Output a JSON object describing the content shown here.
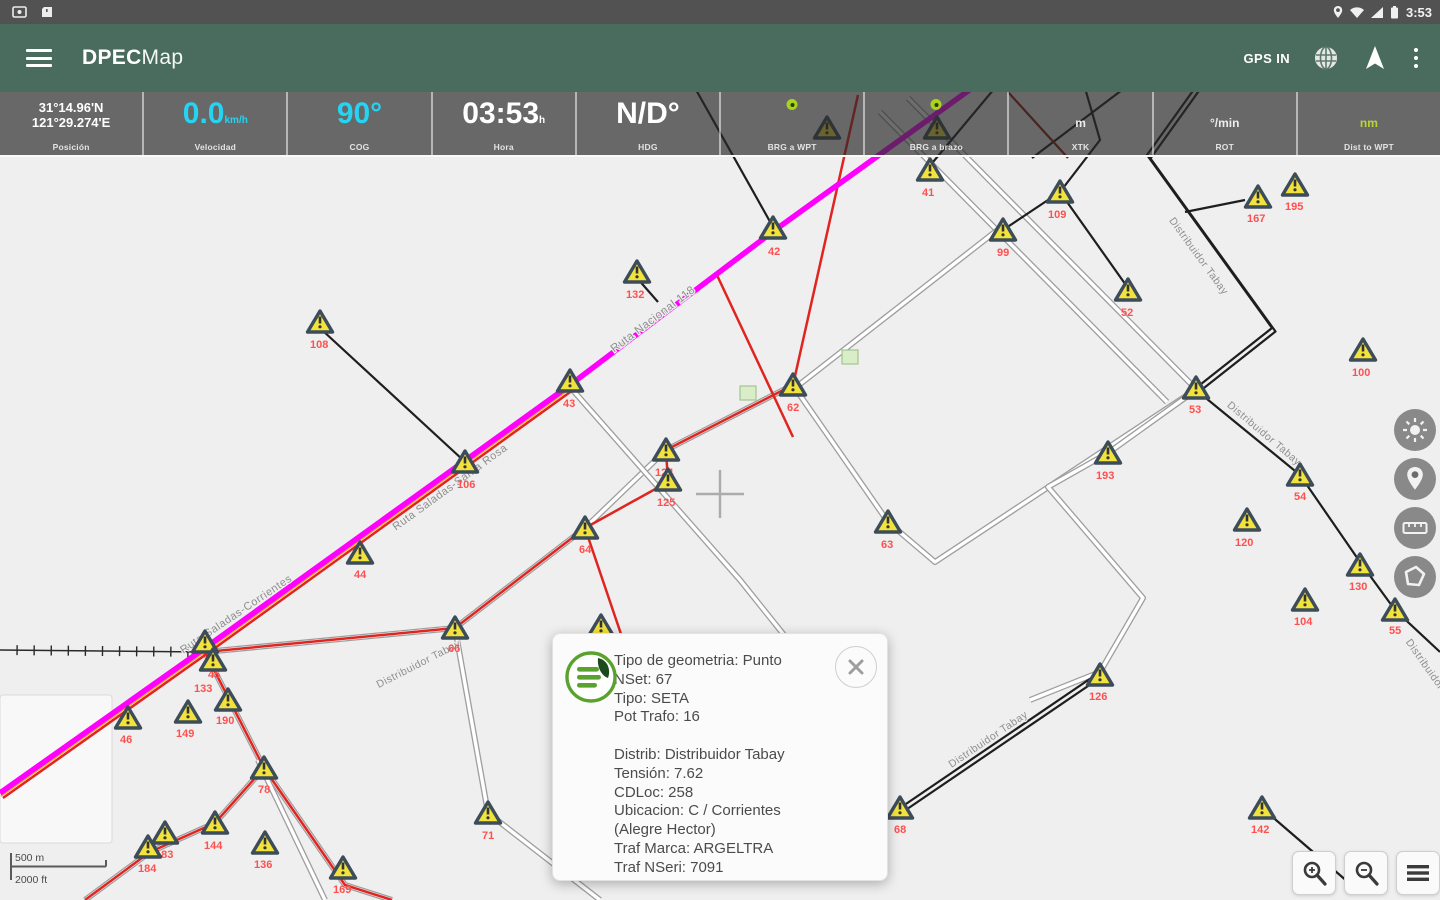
{
  "status_bar": {
    "time": "3:53"
  },
  "app_bar": {
    "title_bold": "DPEC",
    "title_light": "Map",
    "gps_status": "GPS IN"
  },
  "data_bar": {
    "cells": [
      {
        "label": "Posición",
        "style": "coords",
        "value_lines": [
          "31°14.96'N",
          "121°29.274'E"
        ]
      },
      {
        "label": "Velocidad",
        "style": "big-cyan",
        "value": "0.0",
        "unit": "km/h"
      },
      {
        "label": "COG",
        "style": "big-cyan",
        "value": "90°"
      },
      {
        "label": "Hora",
        "style": "big-white",
        "value": "03:53",
        "unit": "h"
      },
      {
        "label": "HDG",
        "style": "big-white",
        "value": "N/D°"
      },
      {
        "label": "BRG a WPT",
        "style": "dot"
      },
      {
        "label": "BRG a brazo",
        "style": "dot"
      },
      {
        "label": "XTK",
        "style": "unit",
        "value": "m"
      },
      {
        "label": "ROT",
        "style": "unit",
        "value": "°/min"
      },
      {
        "label": "Dist to WPT",
        "style": "unit-green",
        "value": "nm"
      }
    ]
  },
  "popup": {
    "lines": [
      "Tipo de geometria: Punto",
      "NSet: 67",
      "Tipo: SETA",
      "Pot Trafo: 16",
      "",
      "Distrib: Distribuidor Tabay",
      "Tensión: 7.62",
      "CDLoc: 258",
      "Ubicacion: C / Corrientes",
      "(Alegre Hector)",
      "Traf Marca: ARGELTRA",
      "Traf NSeri: 7091"
    ]
  },
  "scale_bar": {
    "metric": "500 m",
    "imperial": "2000 ft"
  },
  "map": {
    "colors": {
      "bg": "#EFEFEF",
      "magenta": "#FF00FF",
      "red": "#E02520",
      "darkred": "#8F1A12",
      "orange": "#FFA520",
      "black": "#1E1E1E",
      "road_casing": "#9E9E9E",
      "road_fill": "#FFFFFF",
      "marker_fill": "#F2E23C",
      "marker_stroke": "#3D4C59",
      "label_red": "#FF5050",
      "road_label": "#8E8E8E",
      "building_fill": "#D9EDC8",
      "building_stroke": "#A3C58F",
      "crosshair": "#ABABAB"
    },
    "white_blocks": [
      {
        "x": 0,
        "y": 695,
        "w": 112,
        "h": 148
      }
    ],
    "roads": [
      {
        "pts": [
          [
            908,
            98
          ],
          [
            1195,
            388
          ]
        ]
      },
      {
        "pts": [
          [
            880,
            112
          ],
          [
            1167,
            402
          ]
        ]
      },
      {
        "pts": [
          [
            795,
            388
          ],
          [
            888,
            522
          ],
          [
            935,
            562
          ],
          [
            1195,
            390
          ]
        ]
      },
      {
        "pts": [
          [
            795,
            388
          ],
          [
            1000,
            228
          ]
        ]
      },
      {
        "pts": [
          [
            793,
            385
          ],
          [
            666,
            450
          ],
          [
            585,
            528
          ],
          [
            455,
            628
          ],
          [
            205,
            652
          ]
        ]
      },
      {
        "pts": [
          [
            455,
            628
          ],
          [
            488,
            813
          ],
          [
            600,
            900
          ]
        ]
      },
      {
        "pts": [
          [
            1196,
            390
          ],
          [
            1108,
            453
          ],
          [
            1048,
            487
          ],
          [
            1143,
            598
          ],
          [
            1100,
            672
          ],
          [
            1030,
            700
          ]
        ]
      },
      {
        "pts": [
          [
            570,
            387
          ],
          [
            740,
            580
          ],
          [
            800,
            655
          ]
        ]
      },
      {
        "pts": [
          [
            205,
            652
          ],
          [
            264,
            768
          ],
          [
            215,
            823
          ],
          [
            150,
            852
          ],
          [
            85,
            900
          ]
        ]
      },
      {
        "pts": [
          [
            264,
            768
          ],
          [
            345,
            885
          ],
          [
            392,
            900
          ]
        ]
      },
      {
        "pts": [
          [
            258,
            760
          ],
          [
            325,
            900
          ]
        ]
      }
    ],
    "railways": [
      {
        "pts": [
          [
            0,
            650
          ],
          [
            205,
            652
          ]
        ]
      }
    ],
    "black_lines": [
      {
        "pts": [
          [
            695,
            88
          ],
          [
            773,
            227
          ]
        ]
      },
      {
        "pts": [
          [
            322,
            330
          ],
          [
            463,
            460
          ]
        ]
      },
      {
        "pts": [
          [
            637,
            278
          ],
          [
            658,
            302
          ]
        ]
      },
      {
        "pts": [
          [
            1003,
            230
          ],
          [
            1060,
            192
          ],
          [
            1100,
            140
          ],
          [
            1085,
            88
          ]
        ]
      },
      {
        "pts": [
          [
            1060,
            192
          ],
          [
            1128,
            288
          ]
        ]
      },
      {
        "pts": [
          [
            1215,
            60
          ],
          [
            1147,
            155
          ],
          [
            1272,
            328
          ],
          [
            1196,
            388
          ]
        ],
        "pair": true
      },
      {
        "pts": [
          [
            1185,
            212
          ],
          [
            1245,
            200
          ]
        ]
      },
      {
        "pts": [
          [
            1196,
            390
          ],
          [
            1300,
            475
          ],
          [
            1360,
            562
          ],
          [
            1395,
            610
          ],
          [
            1440,
            652
          ]
        ]
      },
      {
        "pts": [
          [
            1100,
            672
          ],
          [
            900,
            808
          ]
        ],
        "pair": true
      },
      {
        "pts": [
          [
            1262,
            808
          ],
          [
            1348,
            882
          ]
        ]
      },
      {
        "pts": [
          [
            928,
            168
          ],
          [
            1020,
            58
          ]
        ]
      },
      {
        "pts": [
          [
            1032,
            158
          ],
          [
            1122,
            90
          ]
        ]
      }
    ],
    "darkred_lines": [
      {
        "pts": [
          [
            1008,
            92
          ],
          [
            1068,
            158
          ]
        ]
      }
    ],
    "red_lines": [
      {
        "pts": [
          [
            858,
            95
          ],
          [
            793,
            385
          ]
        ]
      },
      {
        "pts": [
          [
            716,
            273
          ],
          [
            793,
            437
          ]
        ]
      },
      {
        "pts": [
          [
            793,
            385
          ],
          [
            666,
            450
          ],
          [
            668,
            482
          ],
          [
            585,
            528
          ],
          [
            455,
            628
          ],
          [
            205,
            652
          ]
        ]
      },
      {
        "pts": [
          [
            585,
            528
          ],
          [
            640,
            690
          ]
        ]
      },
      {
        "pts": [
          [
            205,
            652
          ],
          [
            264,
            768
          ],
          [
            215,
            823
          ],
          [
            150,
            852
          ],
          [
            85,
            900
          ]
        ]
      },
      {
        "pts": [
          [
            264,
            768
          ],
          [
            345,
            885
          ],
          [
            392,
            900
          ]
        ]
      },
      {
        "pts": [
          [
            573,
            390
          ],
          [
            208,
            653
          ],
          [
            3,
            798
          ]
        ]
      }
    ],
    "orange_lines": [
      {
        "pts": [
          [
            571,
            388
          ],
          [
            206,
            651
          ],
          [
            1,
            796
          ]
        ]
      }
    ],
    "magenta_lines": [
      {
        "pts": [
          [
            1018,
            55
          ],
          [
            775,
            230
          ],
          [
            570,
            385
          ],
          [
            205,
            648
          ],
          [
            0,
            793
          ]
        ]
      }
    ],
    "buildings": [
      {
        "x": 748,
        "y": 393
      },
      {
        "x": 850,
        "y": 357
      }
    ],
    "road_labels": [
      {
        "t": "Ruta Nacional 118",
        "x": 655,
        "y": 322,
        "a": -37,
        "s": 11.5
      },
      {
        "t": "Ruta Saladas-Santa Rosa",
        "x": 452,
        "y": 490,
        "a": -36,
        "s": 11
      },
      {
        "t": "Ruta Saladas-Corrientes",
        "x": 238,
        "y": 617,
        "a": -34,
        "s": 11
      },
      {
        "t": "Distribuidor Tabay",
        "x": 1196,
        "y": 258,
        "a": 54,
        "s": 10.5
      },
      {
        "t": "Distribuidor Tabay",
        "x": 1262,
        "y": 436,
        "a": 40,
        "s": 10.5
      },
      {
        "t": "Distribuidor Tabay",
        "x": 420,
        "y": 667,
        "a": -27,
        "s": 10.5
      },
      {
        "t": "Distribuidor Tabay",
        "x": 990,
        "y": 742,
        "a": -34,
        "s": 10.5
      },
      {
        "t": "Distribuidor Tabay",
        "x": 1432,
        "y": 680,
        "a": 55,
        "s": 10.5
      }
    ],
    "crosshair": {
      "x": 720,
      "y": 494
    },
    "markers": [
      {
        "x": 320,
        "y": 322,
        "l": "108",
        "lx": 310,
        "ly": 348
      },
      {
        "x": 570,
        "y": 381,
        "l": "43",
        "lx": 563,
        "ly": 407
      },
      {
        "x": 637,
        "y": 272,
        "l": "132",
        "lx": 626,
        "ly": 298
      },
      {
        "x": 773,
        "y": 228,
        "l": "42",
        "lx": 768,
        "ly": 255
      },
      {
        "x": 930,
        "y": 170,
        "l": "41",
        "lx": 922,
        "ly": 196
      },
      {
        "x": 827,
        "y": 128,
        "l": ""
      },
      {
        "x": 937,
        "y": 128,
        "l": ""
      },
      {
        "x": 1003,
        "y": 230,
        "l": "99",
        "lx": 997,
        "ly": 256
      },
      {
        "x": 1060,
        "y": 192,
        "l": "109",
        "lx": 1048,
        "ly": 218
      },
      {
        "x": 1128,
        "y": 290,
        "l": "52",
        "lx": 1121,
        "ly": 316
      },
      {
        "x": 1258,
        "y": 197,
        "l": "167",
        "lx": 1247,
        "ly": 222
      },
      {
        "x": 1295,
        "y": 185,
        "l": "195",
        "lx": 1285,
        "ly": 210
      },
      {
        "x": 1363,
        "y": 350,
        "l": "100",
        "lx": 1352,
        "ly": 376
      },
      {
        "x": 1196,
        "y": 388,
        "l": "53",
        "lx": 1189,
        "ly": 413
      },
      {
        "x": 793,
        "y": 385,
        "l": "62",
        "lx": 787,
        "ly": 411
      },
      {
        "x": 666,
        "y": 450,
        "l": "124",
        "lx": 655,
        "ly": 476
      },
      {
        "x": 668,
        "y": 480,
        "l": "125",
        "lx": 657,
        "ly": 506
      },
      {
        "x": 585,
        "y": 528,
        "l": "64",
        "lx": 579,
        "ly": 553
      },
      {
        "x": 888,
        "y": 522,
        "l": "63",
        "lx": 881,
        "ly": 548
      },
      {
        "x": 455,
        "y": 628,
        "l": "66",
        "lx": 448,
        "ly": 652
      },
      {
        "x": 488,
        "y": 813,
        "l": "71",
        "lx": 482,
        "ly": 839
      },
      {
        "x": 601,
        "y": 626,
        "l": ""
      },
      {
        "x": 1108,
        "y": 453,
        "l": "193",
        "lx": 1096,
        "ly": 479
      },
      {
        "x": 1300,
        "y": 475,
        "l": "54",
        "lx": 1294,
        "ly": 500
      },
      {
        "x": 1247,
        "y": 520,
        "l": "120",
        "lx": 1235,
        "ly": 546
      },
      {
        "x": 1360,
        "y": 565,
        "l": "130",
        "lx": 1349,
        "ly": 590
      },
      {
        "x": 1305,
        "y": 600,
        "l": "104",
        "lx": 1294,
        "ly": 625
      },
      {
        "x": 1395,
        "y": 610,
        "l": "55",
        "lx": 1389,
        "ly": 634
      },
      {
        "x": 1100,
        "y": 675,
        "l": "126",
        "lx": 1089,
        "ly": 700
      },
      {
        "x": 900,
        "y": 808,
        "l": "68",
        "lx": 894,
        "ly": 833
      },
      {
        "x": 1262,
        "y": 808,
        "l": "142",
        "lx": 1251,
        "ly": 833
      },
      {
        "x": 128,
        "y": 718,
        "l": "46",
        "lx": 120,
        "ly": 743
      },
      {
        "x": 188,
        "y": 712,
        "l": "149",
        "lx": 176,
        "ly": 737
      },
      {
        "x": 228,
        "y": 700,
        "l": "190",
        "lx": 216,
        "ly": 724
      },
      {
        "x": 205,
        "y": 642,
        "l": "45",
        "lx": 208,
        "ly": 678
      },
      {
        "x": 213,
        "y": 660,
        "l": "133",
        "lx": 194,
        "ly": 692
      },
      {
        "x": 264,
        "y": 768,
        "l": "78",
        "lx": 258,
        "ly": 793
      },
      {
        "x": 215,
        "y": 823,
        "l": "144",
        "lx": 204,
        "ly": 849
      },
      {
        "x": 165,
        "y": 833,
        "l": "183",
        "lx": 155,
        "ly": 858
      },
      {
        "x": 148,
        "y": 847,
        "l": "184",
        "lx": 138,
        "ly": 872
      },
      {
        "x": 265,
        "y": 843,
        "l": "136",
        "lx": 254,
        "ly": 868
      },
      {
        "x": 343,
        "y": 868,
        "l": "169",
        "lx": 333,
        "ly": 893
      },
      {
        "x": 465,
        "y": 462,
        "l": "106",
        "lx": 457,
        "ly": 488
      },
      {
        "x": 360,
        "y": 553,
        "l": "44",
        "lx": 354,
        "ly": 578
      }
    ]
  }
}
